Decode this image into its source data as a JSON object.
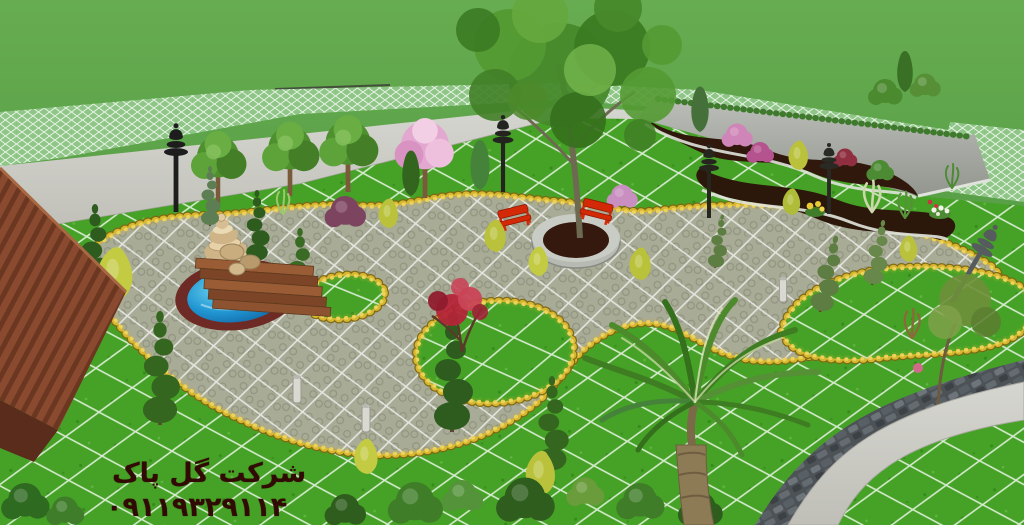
{
  "watermark": {
    "company_name": "شرکت گل پاک",
    "phone_number": "۰۹۱۱۹۳۲۹۱۱۴"
  },
  "scene": {
    "description": "3D landscape architecture render of a villa garden: gridded lawns, curved hexagonal-paver walkways edged with yellow marigold hedges, a tiered stone fountain in a blue pool, a central tree planter with two red benches, terraced flower beds along a grey retaining wall, a fan palm, spiral topiaries, garden lamp posts, and a brown-roofed house at the left",
    "colors": {
      "far_lawn": "#5a9e46",
      "garden_lawn": "#46a226",
      "grid_line": "#ffffff",
      "mesh_lawn": "#8fc687",
      "paver": "#a8ab96",
      "concrete": "#cbcbc5",
      "wall_grey": "#a9ada8",
      "bed_soil": "#30180c",
      "marigold_hedge": "#d8b730",
      "pool_water": "#2196d2",
      "pool_rim": "#6e2a24",
      "fountain_stone": "#d6bd93",
      "bench_red": "#d32906",
      "roof_brown": "#7a3f2a",
      "cobblestone": "#4d5256",
      "palm_green": "#3f7d22",
      "watermark_text": "#310b03"
    }
  }
}
